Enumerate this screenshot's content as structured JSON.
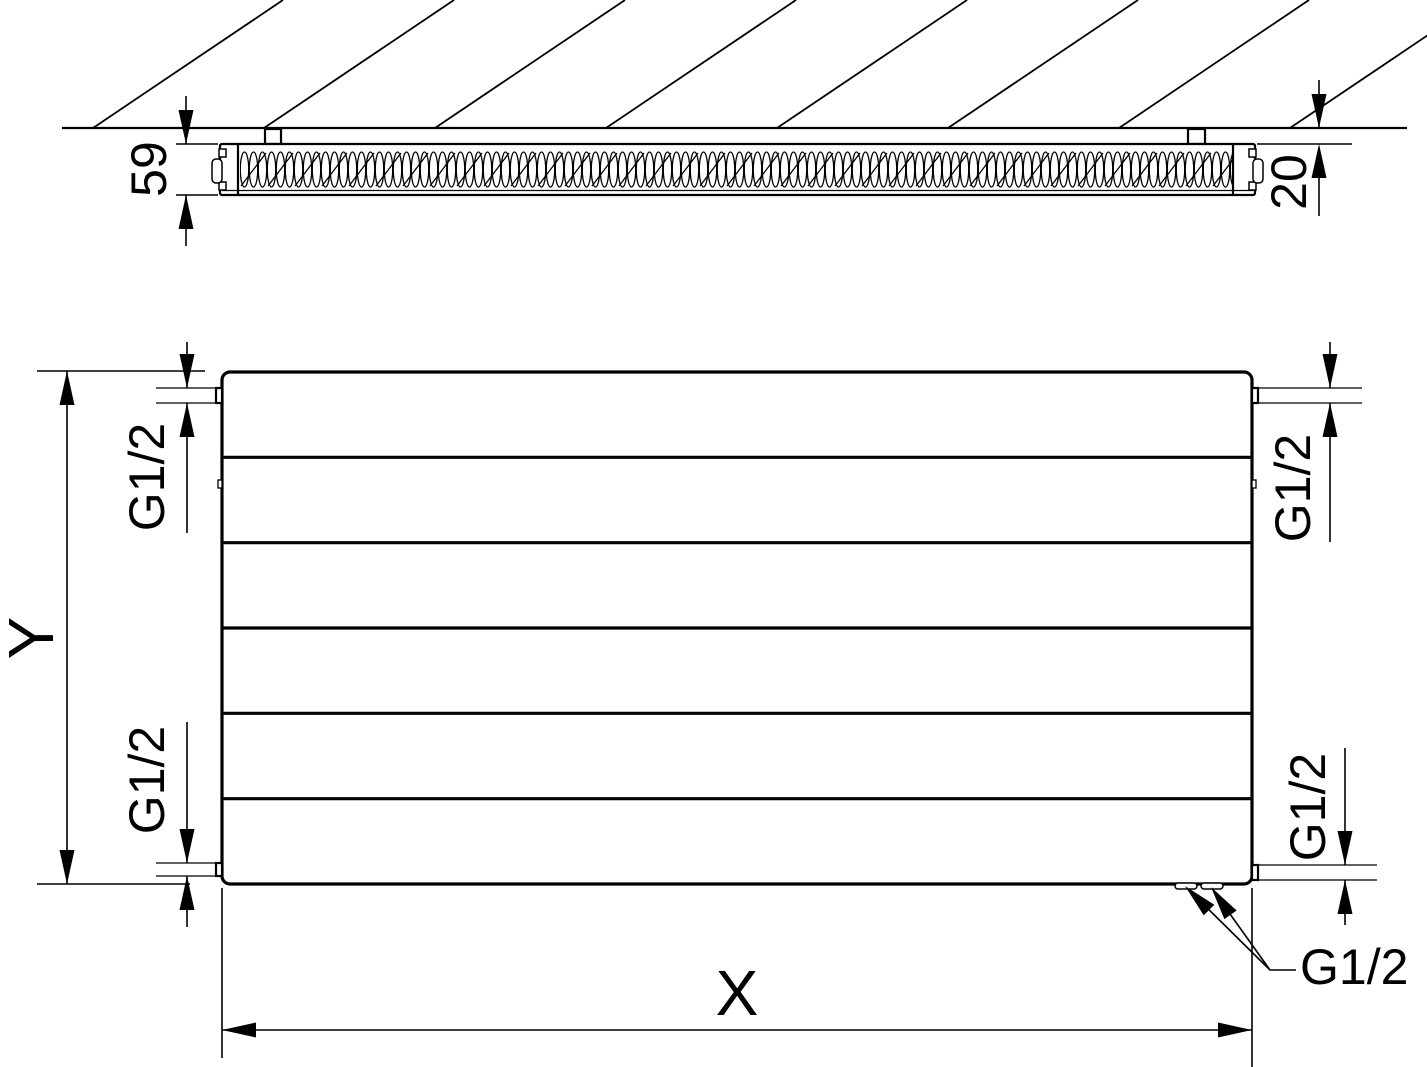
{
  "colors": {
    "background": "#ffffff",
    "line": "#000000"
  },
  "top_view": {
    "depth_dimension": "59",
    "wall_gap_dimension": "20"
  },
  "front_view": {
    "height_dimension": "Y",
    "width_dimension": "X",
    "connection_top_left": "G1/2",
    "connection_bottom_left": "G1/2",
    "connection_top_right": "G1/2",
    "connection_bottom_right_side": "G1/2",
    "connection_bottom": "G1/2"
  }
}
